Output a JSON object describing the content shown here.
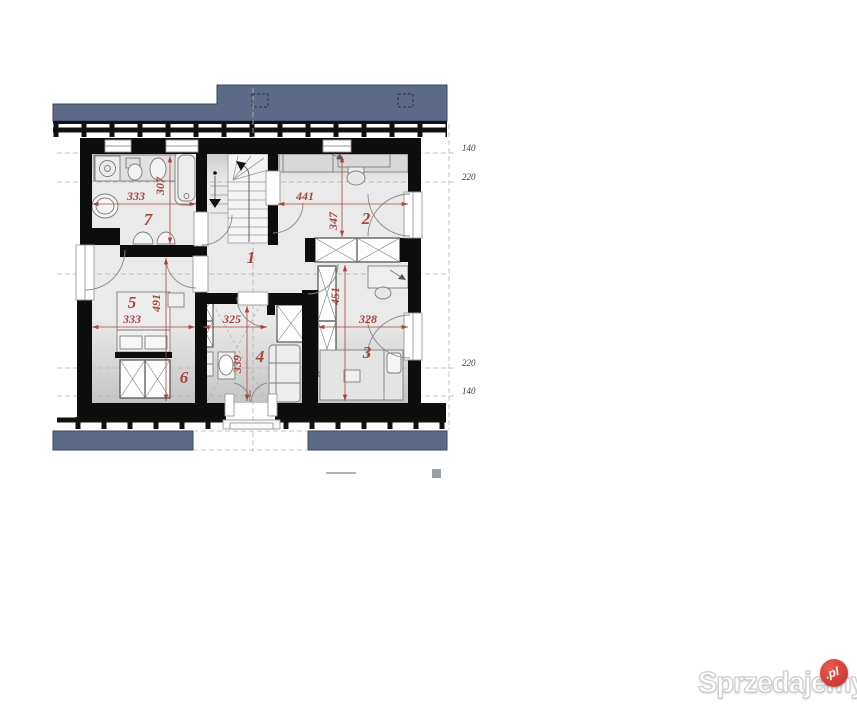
{
  "plan": {
    "rooms": [
      {
        "number": "1"
      },
      {
        "number": "2"
      },
      {
        "number": "3"
      },
      {
        "number": "4"
      },
      {
        "number": "5"
      },
      {
        "number": "6"
      },
      {
        "number": "7"
      }
    ],
    "dims": {
      "bath_w": "333",
      "bath_h": "307",
      "hall_w": "441",
      "bed2_h": "347",
      "bed5_h": "491",
      "bed5_w": "333",
      "room4_w": "325",
      "bed3_w": "328",
      "bed3_h": "451",
      "room4_h": "339"
    },
    "levels": {
      "top_140": "140",
      "top_220": "220",
      "bottom_220": "220",
      "bottom_140": "140"
    }
  },
  "watermark": {
    "brand": "Sprzedajemy",
    "badge": ".pl"
  }
}
